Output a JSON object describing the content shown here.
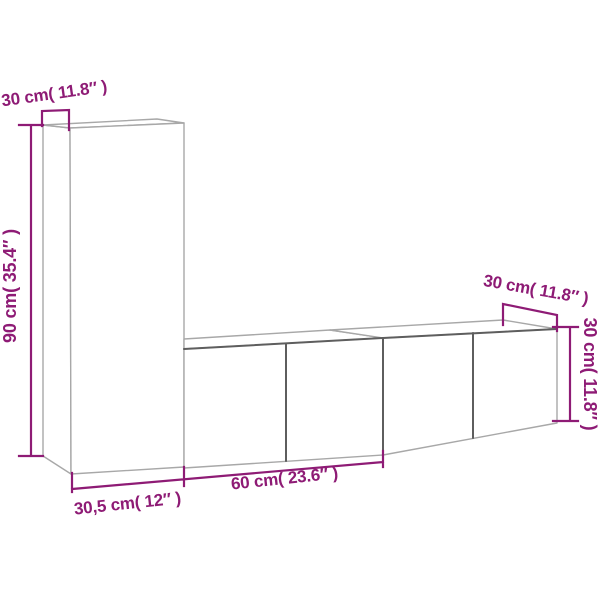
{
  "colors": {
    "background": "#ffffff",
    "dimension": "#8E1B75",
    "outline_light": "#a8a8a8",
    "outline_dark": "#5e5e5e"
  },
  "labels": {
    "tall_cabinet_depth": "30 cm( 11.8″ )",
    "tall_cabinet_height": "90 cm( 35.4″ )",
    "tall_cabinet_width": "30,5 cm( 12″ )",
    "low_cabinet_width": "60 cm( 23.6″ )",
    "low_cabinet_depth": "30 cm( 11.8″ )",
    "low_cabinet_height": "30 cm( 11.8″ )"
  }
}
